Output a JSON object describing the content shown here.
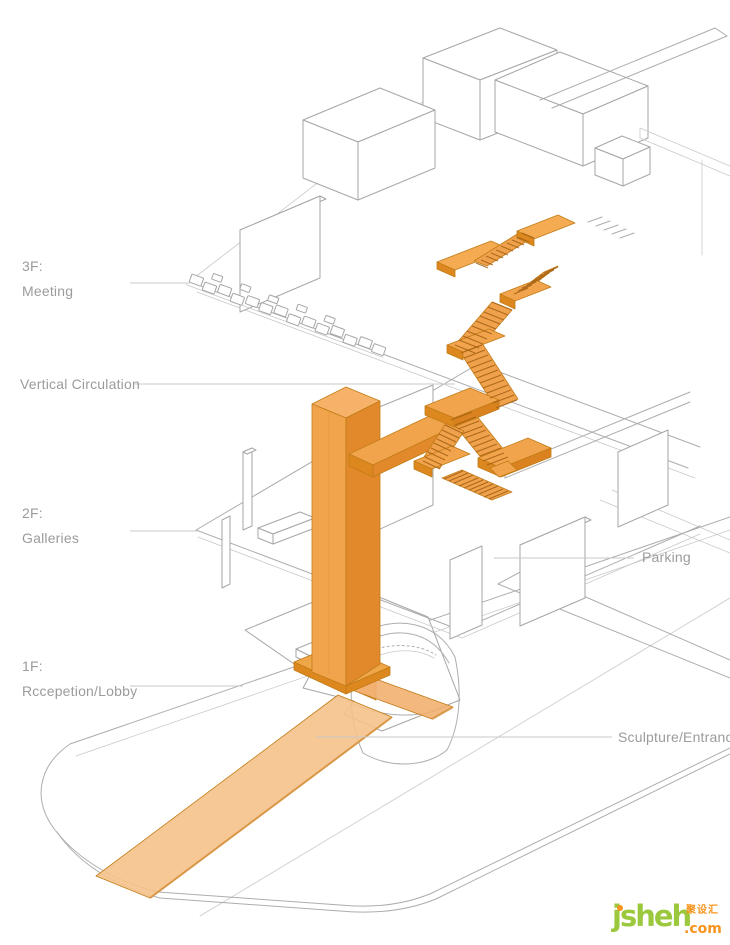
{
  "annotations": {
    "floor3": {
      "code": "3F:",
      "name": "Meeting"
    },
    "vertical_circulation": "Vertical Circulation",
    "floor2": {
      "code": "2F:",
      "name": "Galleries"
    },
    "parking": "Parking",
    "floor1": {
      "code": "1F:",
      "name": "Rccepetion/Lobby"
    },
    "sculpture_entrance": "Sculpture/Entrance"
  },
  "watermark": {
    "brand": "jsheh",
    "tld": ".com",
    "cjk_tag": "聚设汇"
  },
  "colors": {
    "highlight": "#F2A44C",
    "highlight_light": "#F6B268",
    "highlight_dark": "#E1892B",
    "path_fill": "#F5C28A",
    "sketch_line": "#ADADAD",
    "label_text": "#9B9B9B",
    "leader_line": "#C9C9C9",
    "brand_green": "#9CC83D",
    "brand_orange": "#F7941D"
  }
}
